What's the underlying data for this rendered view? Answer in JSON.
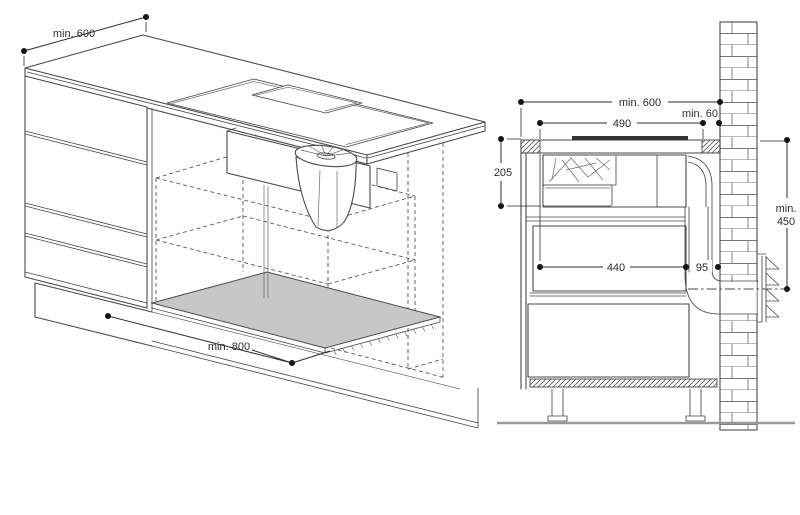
{
  "diagram": {
    "iso": {
      "dim_depth": "min. 600",
      "dim_floor": "min. 800"
    },
    "section": {
      "dim_total": "min. 600",
      "dim_cutout": "490",
      "dim_wall_gap": "min. 60",
      "dim_unit_height": "205",
      "dim_inner_width": "440",
      "dim_duct_depth": "95",
      "dim_vent_l1": "min.",
      "dim_vent_l2": "450"
    },
    "colors": {
      "line": "#4a4a4a",
      "dim": "#2e2e2e",
      "panel_fill": "#c7c7c7",
      "glass": "#333333",
      "floor": "#999999"
    }
  }
}
